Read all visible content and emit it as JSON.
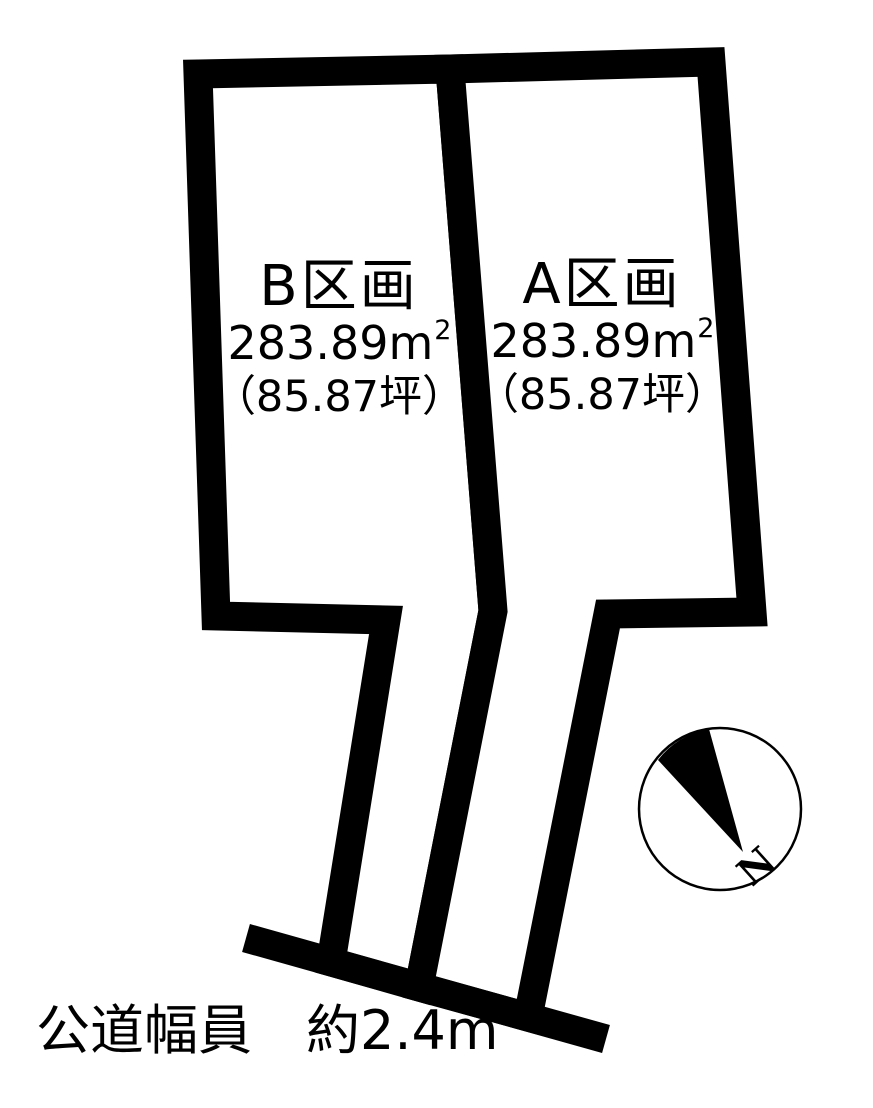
{
  "colors": {
    "ink": "#000000",
    "background": "#ffffff"
  },
  "plots": [
    {
      "id": "B",
      "label": "B区画",
      "area_value": "283.89",
      "area_unit": "m",
      "area_exponent": "2",
      "tsubo": "（85.87坪）"
    },
    {
      "id": "A",
      "label": "A区画",
      "area_value": "283.89",
      "area_unit": "m",
      "area_exponent": "2",
      "tsubo": "（85.87坪）"
    }
  ],
  "road": {
    "label": "公道幅員　約2.4m"
  },
  "compass": {
    "letter": "N"
  }
}
